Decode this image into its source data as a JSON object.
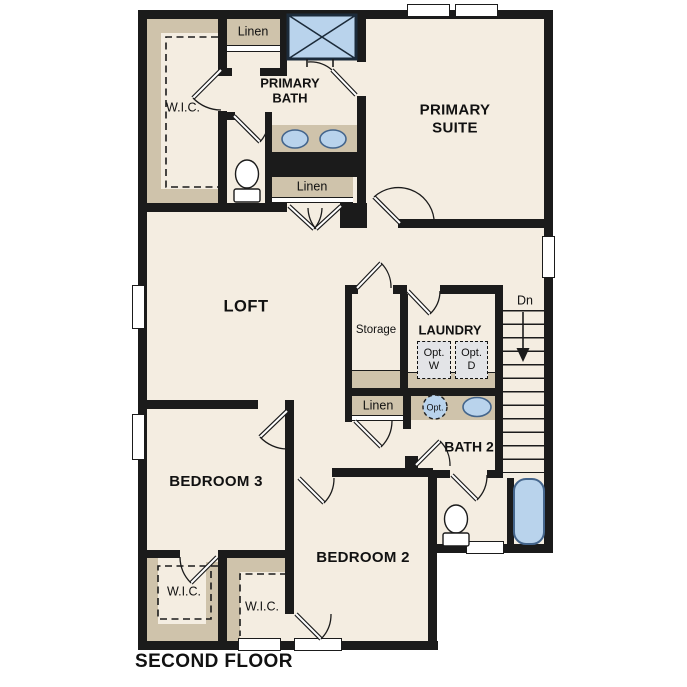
{
  "labels": {
    "primary_suite": "PRIMARY\nSUITE",
    "primary_bath": "PRIMARY\nBATH",
    "loft": "LOFT",
    "bedroom2": "BEDROOM 2",
    "bedroom3": "BEDROOM 3",
    "bath2": "BATH 2",
    "laundry": "LAUNDRY",
    "storage": "Storage",
    "wic_primary": "W.I.C.",
    "wic_bedroom3": "W.I.C.",
    "wic_bedroom2": "W.I.C.",
    "linen_upper": "Linen",
    "linen_primary_bath": "Linen",
    "linen_hall": "Linen",
    "stairs_down": "Dn",
    "opt_washer": "Opt.\nW",
    "opt_dryer": "Opt.\nD",
    "opt_sink": "Opt.",
    "floor_title": "SECOND FLOOR"
  },
  "colors": {
    "wall": "#1b1b1b",
    "floor": "#f4ede1",
    "casework": "#cfc3ab",
    "fixture_fill": "#b9d3ec",
    "fixture_stroke": "#44658c",
    "optional_fill": "#e3e4e7",
    "background": "#ffffff"
  }
}
